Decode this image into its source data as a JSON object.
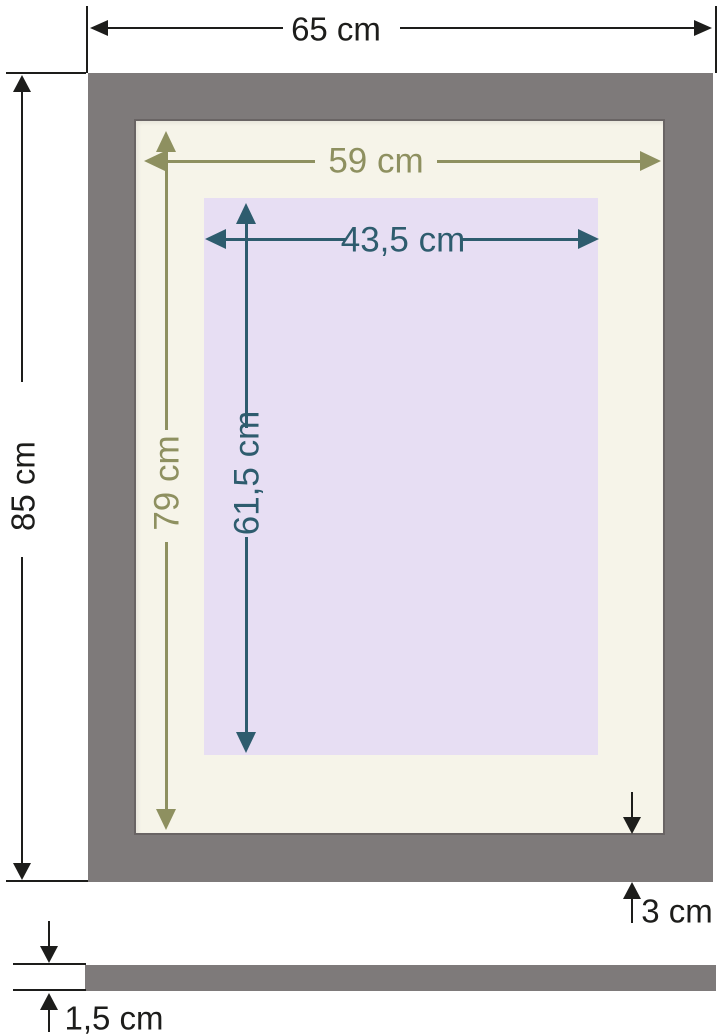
{
  "page": {
    "background": "#ffffff"
  },
  "diagram": {
    "type": "picture-frame-dimension-diagram",
    "front_view": {
      "outer_width_label": "65 cm",
      "outer_height_label": "85 cm",
      "mat_width_label": "59 cm",
      "mat_height_label": "79 cm",
      "opening_width_label": "43,5 cm",
      "opening_height_label": "61,5 cm",
      "frame_face_label": "3 cm"
    },
    "side_view": {
      "profile_depth_label": "1,5 cm"
    },
    "colors": {
      "frame": "#7e7a7a",
      "mat": "#f6f4e9",
      "opening": "#e7def3",
      "ink": "#1d1d1b",
      "olive": "#8e9060",
      "teal": "#2e5c6e",
      "bg": "#ffffff"
    }
  }
}
